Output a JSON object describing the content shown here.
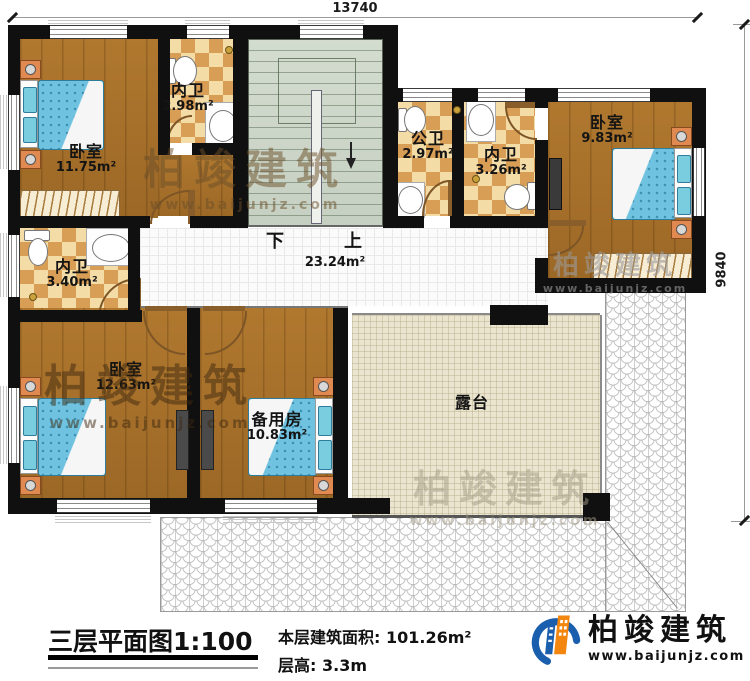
{
  "dimensions": {
    "width_label": "13740",
    "height_label": "9840"
  },
  "rooms": {
    "bedroom_tl": {
      "name": "卧室",
      "area": "11.75m²"
    },
    "ensuite_tl": {
      "name": "内卫",
      "area": "2.98m²"
    },
    "public_bath": {
      "name": "公卫",
      "area": "2.97m²"
    },
    "ensuite_tr": {
      "name": "内卫",
      "area": "3.26m²"
    },
    "bedroom_tr": {
      "name": "卧室",
      "area": "9.83m²"
    },
    "ensuite_ml": {
      "name": "内卫",
      "area": "3.40m²"
    },
    "bedroom_bl": {
      "name": "卧室",
      "area": "12.63m²"
    },
    "spare_room": {
      "name": "备用房",
      "area": "10.83m²"
    },
    "terrace": {
      "name": "露台"
    },
    "hall": {
      "area": "23.24m²",
      "down": "下",
      "up": "上"
    }
  },
  "footer": {
    "title": "三层平面图1:100",
    "area_label": "本层建筑面积:",
    "area_value": "101.26m²",
    "floor_height_label": "层高:",
    "floor_height_value": "3.3m"
  },
  "brand": {
    "name": "柏竣建筑",
    "website": "www.baijunjz.com"
  },
  "watermark": {
    "name": "柏竣建筑",
    "website": "www.baijunjz.com"
  },
  "colors": {
    "wall": "#101010",
    "wood": "#a9712c",
    "tile_light": "#f4dca6",
    "tile_dark": "#d89e55",
    "stairs": "#cdd5c9",
    "terrace": "#ebe5cf",
    "bed": "#6fc2e0",
    "brand_blue": "#1a5fae",
    "brand_orange": "#f2860f"
  }
}
